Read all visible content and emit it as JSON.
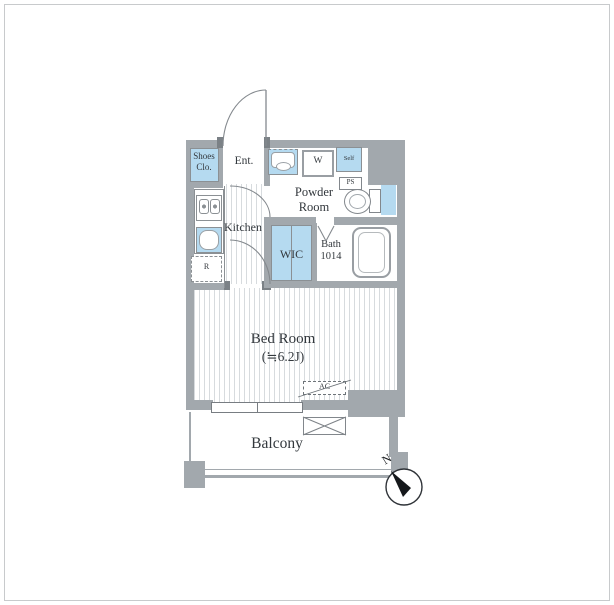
{
  "plan": {
    "rooms": {
      "shoes_closet": {
        "line1": "Shoes",
        "line2": "Clo."
      },
      "entrance": {
        "label": "Ent."
      },
      "powder_room": {
        "line1": "Powder",
        "line2": "Room"
      },
      "kitchen": {
        "label": "Kitchen"
      },
      "wic": {
        "label": "WIC"
      },
      "bath": {
        "line1": "Bath",
        "line2": "1014"
      },
      "bedroom": {
        "line1": "Bed Room",
        "line2": "(≒6.2J)"
      },
      "balcony": {
        "label": "Balcony"
      }
    },
    "labels": {
      "washer": "W",
      "self": "Self",
      "pipe_space": "PS",
      "refrigerator": "R",
      "air_conditioner": "AC",
      "north": "N"
    },
    "colors": {
      "accent_blue": "#b5daf0",
      "wall_gray": "#a2a8ad"
    }
  }
}
